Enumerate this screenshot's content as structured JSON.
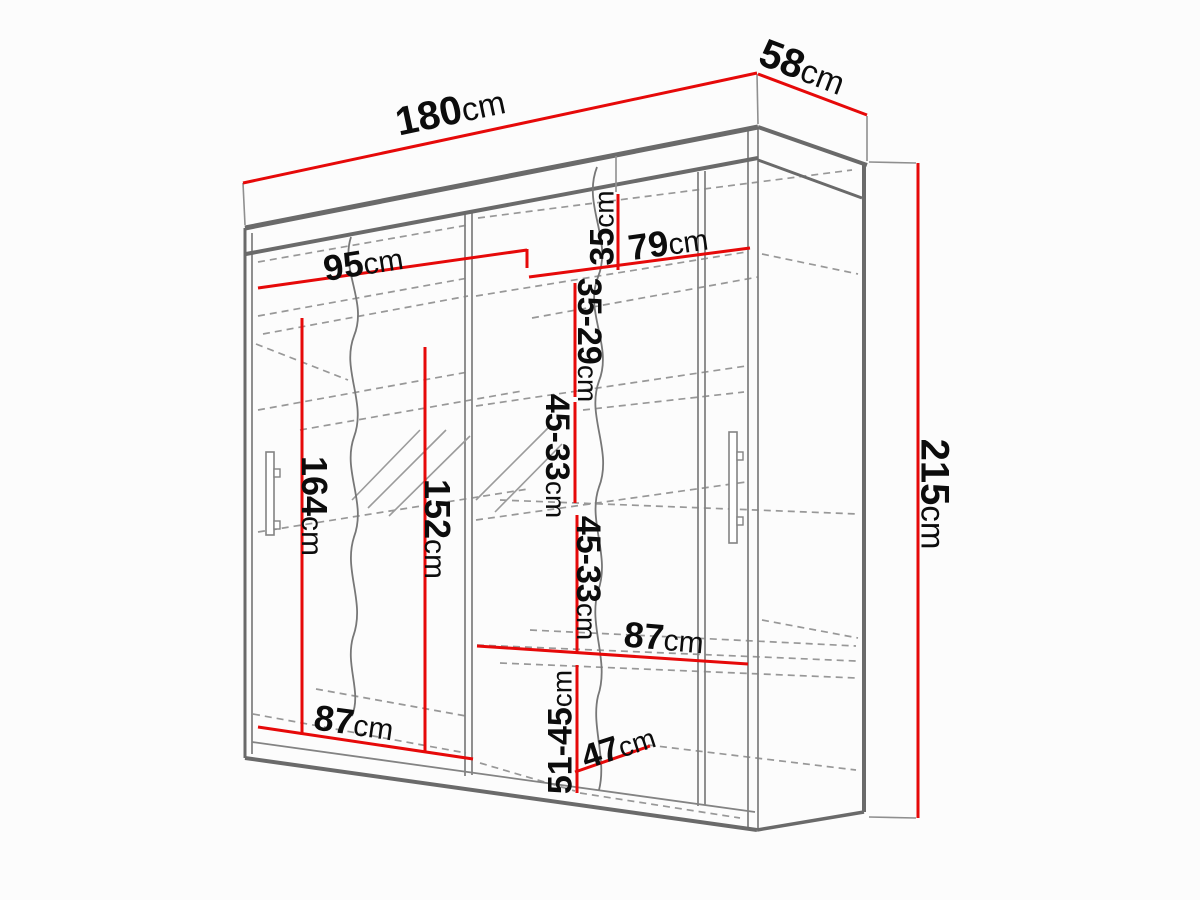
{
  "diagram": {
    "type": "wardrobe-dimension-drawing",
    "unit_label": "cm",
    "overall_dimensions": {
      "width": "180cm",
      "depth": "58cm",
      "height": "215cm"
    },
    "colors": {
      "dimension_line": "#e60909",
      "cabinet_outline": "#6a6a6a",
      "cabinet_thin": "#838383",
      "cabinet_dashed": "#989898",
      "label_text": "#0c0c0c",
      "background": "#fcfcfc"
    },
    "dimensions": [
      {
        "id": "180",
        "value": "180",
        "unit": "cm",
        "line": [
          243,
          183,
          757,
          73
        ],
        "lx": 450,
        "ly": 110,
        "rot": -12,
        "fs": 40
      },
      {
        "id": "58",
        "value": "58",
        "unit": "cm",
        "line": [
          758,
          74,
          867,
          115
        ],
        "lx": 803,
        "ly": 66,
        "rot": 21,
        "fs": 40
      },
      {
        "id": "215",
        "value": "215",
        "unit": "cm",
        "line": [
          918,
          163,
          918,
          818
        ],
        "lx": 936,
        "ly": 494,
        "rot": 90,
        "fs": 40
      },
      {
        "id": "95",
        "value": "95",
        "unit": "cm",
        "line": [
          258,
          288,
          527,
          250
        ],
        "lx": 363,
        "ly": 262,
        "rot": -9,
        "fs": 36
      },
      {
        "id": "79",
        "value": "79",
        "unit": "cm",
        "line": [
          529,
          277,
          750,
          248
        ],
        "lx": 668,
        "ly": 242,
        "rot": -8,
        "fs": 36
      },
      {
        "id": "35",
        "value": "35",
        "unit": "cm",
        "line": [
          618,
          194,
          618,
          270
        ],
        "lx": 601,
        "ly": 228,
        "rot": -90,
        "fs": 34
      },
      {
        "id": "35-29",
        "value": "35-29",
        "unit": "cm",
        "line": [
          575,
          283,
          575,
          397
        ],
        "lx": 590,
        "ly": 340,
        "rot": 90,
        "fs": 34
      },
      {
        "id": "45-33a",
        "value": "45-33",
        "unit": "cm",
        "line": [
          575,
          402,
          575,
          503
        ],
        "lx": 558,
        "ly": 456,
        "rot": 90,
        "fs": 34
      },
      {
        "id": "45-33b",
        "value": "45-33",
        "unit": "cm",
        "line": [
          577,
          515,
          577,
          652
        ],
        "lx": 589,
        "ly": 578,
        "rot": 90,
        "fs": 34
      },
      {
        "id": "51-45",
        "value": "51-45",
        "unit": "cm",
        "line": [
          577,
          665,
          577,
          793
        ],
        "lx": 559,
        "ly": 732,
        "rot": -90,
        "fs": 34
      },
      {
        "id": "164",
        "value": "164",
        "unit": "cm",
        "line": [
          302,
          318,
          302,
          735
        ],
        "lx": 315,
        "ly": 506,
        "rot": 90,
        "fs": 36
      },
      {
        "id": "152",
        "value": "152",
        "unit": "cm",
        "line": [
          425,
          347,
          425,
          753
        ],
        "lx": 438,
        "ly": 529,
        "rot": 90,
        "fs": 36
      },
      {
        "id": "87shelf",
        "value": "87",
        "unit": "cm",
        "line": [
          477,
          646,
          748,
          664
        ],
        "lx": 664,
        "ly": 637,
        "rot": 5,
        "fs": 36
      },
      {
        "id": "87bottom",
        "value": "87",
        "unit": "cm",
        "line": [
          258,
          727,
          473,
          759
        ],
        "lx": 354,
        "ly": 722,
        "rot": 8,
        "fs": 36
      },
      {
        "id": "47",
        "value": "47",
        "unit": "cm",
        "line": [
          575,
          772,
          650,
          746
        ],
        "lx": 618,
        "ly": 746,
        "rot": -18,
        "fs": 34
      }
    ],
    "red_ticks": [
      [
        527,
        249,
        527,
        268
      ]
    ],
    "extension_lines": [
      [
        243,
        183,
        245,
        225
      ],
      [
        757,
        74,
        758,
        124
      ],
      [
        867,
        116,
        867,
        161
      ],
      [
        869,
        162,
        916,
        163
      ],
      [
        869,
        817,
        916,
        818
      ],
      [
        616,
        156,
        616,
        192
      ]
    ],
    "cabinet": {
      "thick_lines": [
        [
          245,
          228,
          758,
          127,
          5
        ],
        [
          246,
          254,
          758,
          158,
          4
        ],
        [
          758,
          127,
          867,
          165,
          4
        ],
        [
          758,
          160,
          862,
          198,
          3
        ],
        [
          864,
          165,
          864,
          812,
          4
        ],
        [
          245,
          758,
          757,
          830,
          4
        ],
        [
          757,
          830,
          864,
          812,
          3.5
        ],
        [
          245,
          228,
          245,
          758,
          3
        ]
      ],
      "thin_lines": [
        [
          252,
          233,
          252,
          754
        ],
        [
          748,
          131,
          748,
          828
        ],
        [
          758,
          127,
          758,
          830
        ],
        [
          465,
          213,
          465,
          776
        ],
        [
          472,
          212,
          472,
          775
        ],
        [
          698,
          172,
          698,
          806
        ],
        [
          705,
          171,
          705,
          805
        ],
        [
          252,
          742,
          755,
          812
        ]
      ],
      "dashed_lines": [
        [
          258,
          262,
          468,
          225
        ],
        [
          258,
          316,
          468,
          278
        ],
        [
          263,
          334,
          468,
          296
        ],
        [
          256,
          344,
          348,
          380
        ],
        [
          258,
          410,
          468,
          372
        ],
        [
          300,
          430,
          522,
          391
        ],
        [
          258,
          532,
          528,
          489
        ],
        [
          253,
          714,
          466,
          753
        ],
        [
          316,
          689,
          466,
          716
        ],
        [
          478,
          218,
          852,
          170
        ],
        [
          476,
          296,
          746,
          252
        ],
        [
          532,
          318,
          758,
          277
        ],
        [
          762,
          254,
          858,
          274
        ],
        [
          476,
          406,
          746,
          366
        ],
        [
          583,
          410,
          744,
          392
        ],
        [
          476,
          520,
          746,
          482
        ],
        [
          500,
          500,
          858,
          514
        ],
        [
          762,
          620,
          858,
          638
        ],
        [
          530,
          630,
          856,
          646
        ],
        [
          477,
          645,
          856,
          661
        ],
        [
          500,
          663,
          856,
          678
        ],
        [
          648,
          745,
          856,
          770
        ],
        [
          580,
          793,
          740,
          818
        ],
        [
          480,
          763,
          575,
          791
        ]
      ],
      "handles": [
        {
          "x": 266,
          "y": 452,
          "w": 8,
          "h": 83,
          "tabs": [
            [
              274,
              469,
              6,
              8
            ],
            [
              274,
              521,
              6,
              8
            ]
          ]
        },
        {
          "x": 729,
          "y": 432,
          "w": 8,
          "h": 111,
          "tabs": [
            [
              737,
              452,
              6,
              8
            ],
            [
              737,
              517,
              6,
              8
            ]
          ]
        }
      ],
      "mirror_hatch": [
        [
          352,
          500,
          420,
          430
        ],
        [
          368,
          508,
          446,
          430
        ],
        [
          389,
          516,
          470,
          436
        ],
        [
          476,
          500,
          548,
          428
        ],
        [
          495,
          512,
          562,
          444
        ]
      ],
      "break_lines": [
        "M351,237 C340,270 368,302 354,336 C341,370 367,402 354,437 C342,471 367,502 354,537 C343,571 366,602 353,637 C345,666 362,691 352,716",
        "M597,167 C582,205 613,240 598,277 C584,312 613,346 599,381 C586,416 613,451 599,487 C587,521 611,556 598,591 C588,626 610,661 598,696 C591,726 607,759 599,790"
      ]
    }
  }
}
